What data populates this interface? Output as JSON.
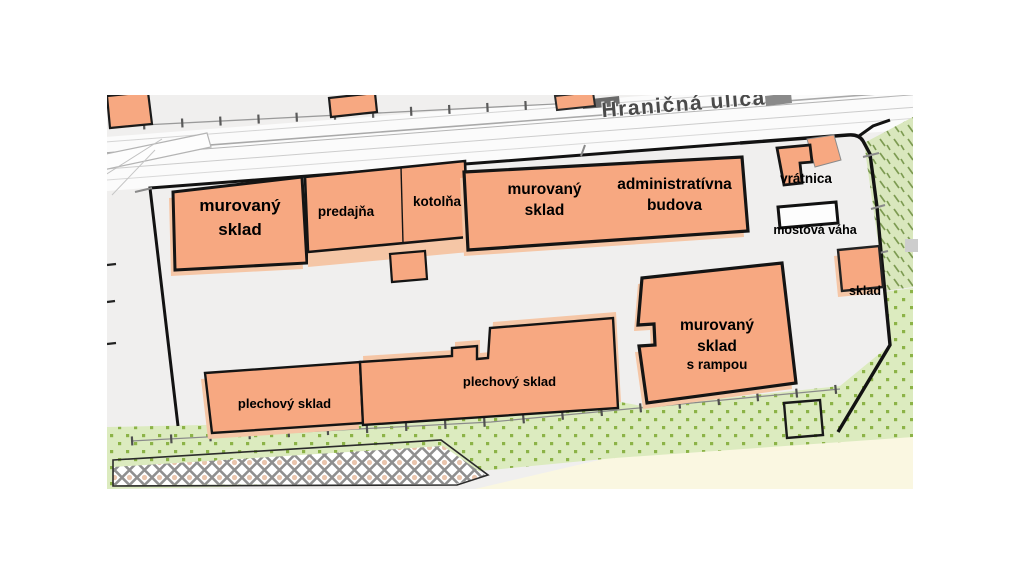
{
  "street": {
    "name": "Hraničná ulica"
  },
  "labels": {
    "murovany_sklad_west": "murovaný\nsklad",
    "predajna": "predajňa",
    "kotolna": "kotolňa",
    "murovany_sklad_central": "murovaný\nsklad",
    "administrativna_budova": "administratívna\nbudova",
    "vratnica": "vrátnica",
    "mostova_vaha": "mostová váha",
    "sklad_small": "sklad",
    "murovany_sklad_rampa_main": "murovaný\nsklad",
    "murovany_sklad_rampa_sub": "s rampou",
    "plechovy_sklad_west": "plechový sklad",
    "plechovy_sklad_central": "plechový sklad"
  },
  "colors": {
    "building_fill": "#F7A881",
    "building_shadow": "#F5C6A6",
    "building_outline": "#141414",
    "ground": "#F0EFEE",
    "street": "#FBFBFB",
    "grass_dotted_bg": "#DCEBBF",
    "grass_dot": "#8CB347",
    "scrub_hatch_bg": "#D9E7BD",
    "scrub_hatch_dash": "#7D9B52",
    "cream": "#FAF7E1",
    "weighbridge_fill": "#FDFDFD"
  }
}
